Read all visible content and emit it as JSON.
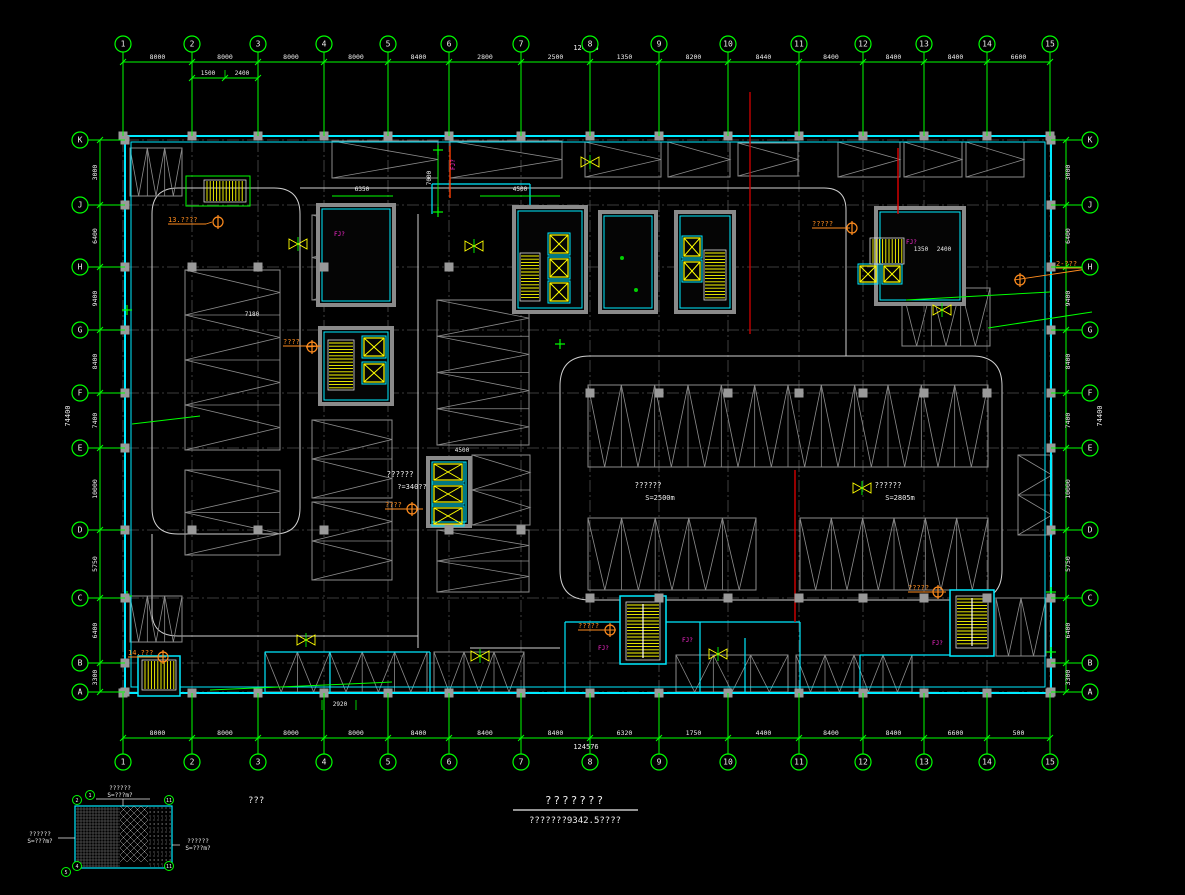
{
  "app": {
    "name": "cad-floor-plan-viewer"
  },
  "grid": {
    "top_labels": [
      "1",
      "2",
      "3",
      "4",
      "5",
      "6",
      "7",
      "8",
      "9",
      "10",
      "11",
      "12",
      "13",
      "14",
      "15"
    ],
    "bottom_labels": [
      "1",
      "2",
      "3",
      "4",
      "5",
      "6",
      "7",
      "8",
      "9",
      "10",
      "11",
      "12",
      "13",
      "14",
      "15"
    ],
    "left_labels": [
      "K",
      "J",
      "H",
      "G",
      "F",
      "E",
      "D",
      "C",
      "B",
      "A"
    ],
    "right_labels": [
      "K",
      "J",
      "H",
      "G",
      "F",
      "E",
      "D",
      "C",
      "B",
      "A"
    ]
  },
  "dims": {
    "top": [
      "8000",
      "8000",
      "8000",
      "8000",
      "8400",
      "2800",
      "2500",
      "1350",
      "8200",
      "8440",
      "8400",
      "8400",
      "8400",
      "6600"
    ],
    "top_total": "124576",
    "top_sub": [
      "1500",
      "2400"
    ],
    "bottom": [
      "8000",
      "8000",
      "8000",
      "8000",
      "8400",
      "8400",
      "8400",
      "6320",
      "1750",
      "4400",
      "8400",
      "8400",
      "6600",
      "500"
    ],
    "bottom_total": "124576",
    "bottom_sub": "2920",
    "left": [
      "3000",
      "6400",
      "9400",
      "8400",
      "7400",
      "10000",
      "5750",
      "6400",
      "3300"
    ],
    "left_total": "74400",
    "right": [
      "3000",
      "6400",
      "9400",
      "8400",
      "7400",
      "10000",
      "5750",
      "6400",
      "3300"
    ],
    "right_total": "74400",
    "misc": [
      "6350",
      "4500",
      "7000",
      "1350",
      "2400",
      "7180",
      "4500"
    ]
  },
  "annotations": {
    "orange": [
      {
        "text": "13.????"
      },
      {
        "text": "14.???"
      },
      {
        "text": "?????"
      },
      {
        "text": "?????"
      },
      {
        "text": "????"
      },
      {
        "text": "????"
      },
      {
        "text": "2-???"
      },
      {
        "text": "?????"
      }
    ],
    "magenta": [
      "FJ?",
      "FJ?",
      "FJ?",
      "FJ?",
      "FJ?",
      "FJ?"
    ]
  },
  "areas": [
    {
      "name": "??????",
      "size": "S=2500m"
    },
    {
      "name": "??????",
      "size": "S=2805m"
    },
    {
      "name": "??????",
      "size": "?=340??"
    }
  ],
  "keyplan": {
    "top_label": "??????",
    "top_size": "S=???m?",
    "left_label": "??????",
    "left_size": "S=???m?",
    "right_label": "??????",
    "right_size": "S=???m?",
    "bubbles": [
      "2",
      "1",
      "11",
      "4",
      "5",
      "11"
    ]
  },
  "title": {
    "line1": "???????",
    "line2": "???????9342.5????",
    "note": "???"
  }
}
